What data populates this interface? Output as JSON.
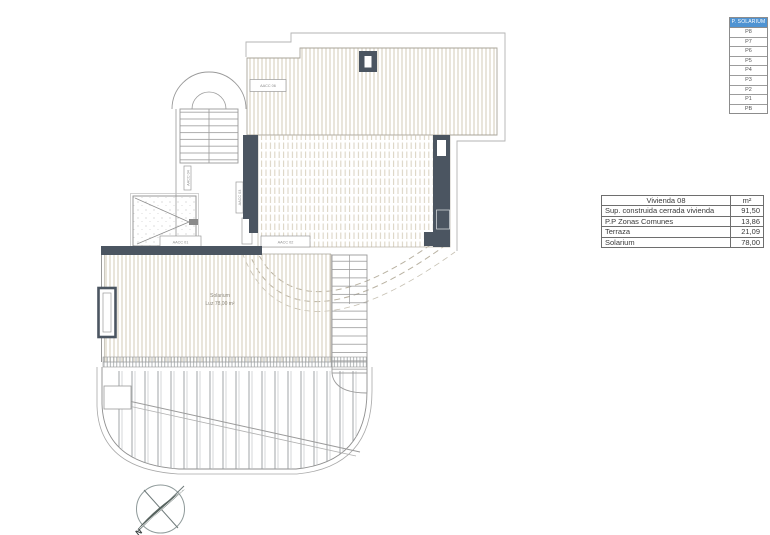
{
  "floor_selector": {
    "header": "P. SOLARIUM",
    "floors": [
      "P8",
      "P7",
      "P6",
      "P5",
      "P4",
      "P3",
      "P2",
      "P1",
      "PB"
    ]
  },
  "area_table": {
    "title": "Vivienda 08",
    "unit": "m²",
    "rows": [
      {
        "label": "Sup. construida cerrada vivienda",
        "value": "91,50"
      },
      {
        "label": "P.P Zonas Comunes",
        "value": "13,86"
      },
      {
        "label": "Terraza",
        "value": "21,09"
      },
      {
        "label": "Solarium",
        "value": "78,00"
      }
    ]
  },
  "plan": {
    "solarium_label": {
      "line1": "Solarium",
      "line2": "Luz 78,00 m²"
    },
    "unit_labels": {
      "acc06": "AACC 06",
      "acc01": "AACC 01",
      "acc02": "AACC 02",
      "acc03": "AACC 03",
      "acc04": "AACC 04"
    },
    "compass": {
      "north": "N"
    },
    "colors": {
      "wall": "#4b5561",
      "stripe": "#d7cfbd",
      "accent_header": "#4f93d2"
    }
  }
}
